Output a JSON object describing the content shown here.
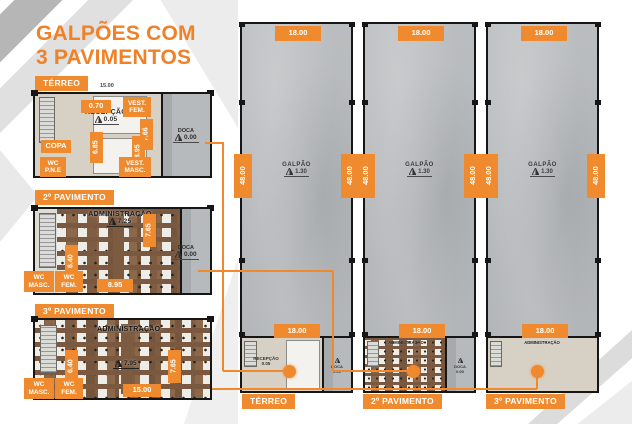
{
  "title": {
    "line1": "GALPÕES COM",
    "line2": "3 PAVIMENTOS"
  },
  "colors": {
    "orange": "#ef8b2e",
    "title_orange": "#ef8228",
    "hall_gray": "#b8bbbd",
    "wood_brown": "#7f5d42"
  },
  "plans": {
    "terreo": {
      "label": "TÉRREO",
      "dim_top": "15.00",
      "dim_070": "0.70",
      "vest_fem": "VEST. FEM.",
      "recepcao": "RECEPÇÃO",
      "recepcao_level": "0.05",
      "dim_766": "7.66",
      "copa": "COPA",
      "dim_685": "6.85",
      "dim_895": "8.95",
      "wc_pne": "WC P.N.E",
      "vest_masc": "VEST. MASC.",
      "doca": "DOCA",
      "doca_level": "0.00"
    },
    "pav2": {
      "label": "2º PAVIMENTO",
      "room": "ADMINISTRAÇÃO",
      "room_level": "7.25",
      "dim_765": "7.65",
      "dim_640": "6.40",
      "dim_895": "8.95",
      "wc_masc": "WC MASC.",
      "wc_fem": "WC FEM.",
      "doca": "DOCA",
      "doca_level": "0.00"
    },
    "pav3": {
      "label": "3º PAVIMENTO",
      "room": "ADMINISTRAÇÃO",
      "room_level": "7.95",
      "dim_640": "6.40",
      "dim_765": "7.65",
      "dim_1500": "15.00",
      "wc_masc": "WC MASC.",
      "wc_fem": "WC FEM."
    }
  },
  "warehouses": [
    {
      "dim_top": "18.00",
      "dim_left": "48.00",
      "dim_right": "48.00",
      "area": "GALPÃO",
      "area_level": "1.30",
      "dim_bottom": "18.00",
      "floor_label": "TÉRREO",
      "mini_room": "RECEPÇÃO",
      "mini_level": "0.05",
      "dock": "DOCA",
      "dock_level": "0.00"
    },
    {
      "dim_top": "18.00",
      "dim_left": "48.00",
      "dim_right": "48.00",
      "area": "GALPÃO",
      "area_level": "1.30",
      "dim_bottom": "18.00",
      "floor_label": "2º PAVIMENTO",
      "mini_room": "ADMINISTRAÇÃO",
      "dock": "DOCA",
      "dock_level": "0.00"
    },
    {
      "dim_top": "18.00",
      "dim_left": "48.00",
      "dim_right": "48.00",
      "area": "GALPÃO",
      "area_level": "1.30",
      "dim_bottom": "18.00",
      "floor_label": "3º PAVIMENTO",
      "mini_room": "ADMINISTRAÇÃO"
    }
  ]
}
